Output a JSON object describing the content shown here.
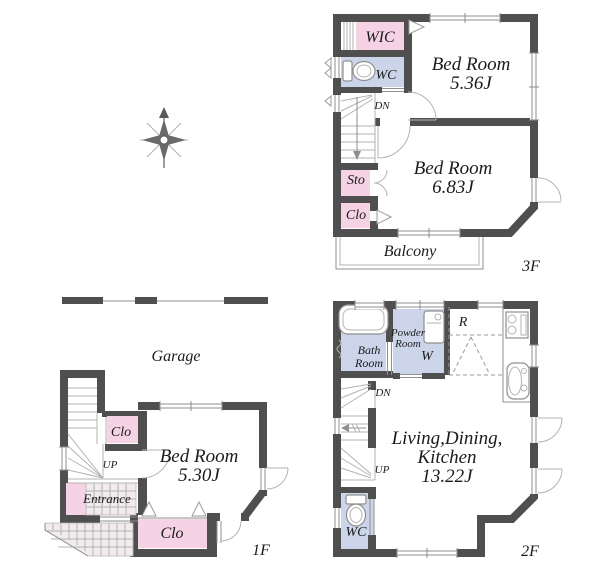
{
  "colors": {
    "wall": "#4f4f4f",
    "room_pink": "#f5d3e4",
    "room_blue": "#ccd4e9",
    "thin_line": "#8f8f8f",
    "tile": "#f2ebee"
  },
  "floor3": {
    "floor_label": "3F",
    "wic": "WIC",
    "wc": "WC",
    "dn": "DN",
    "bedroom_a": {
      "name": "Bed Room",
      "area": "5.36J"
    },
    "bedroom_b": {
      "name": "Bed Room",
      "area": "6.83J"
    },
    "sto": "Sto",
    "clo": "Clo",
    "balcony": "Balcony"
  },
  "floor2": {
    "floor_label": "2F",
    "bath": {
      "line1": "Bath",
      "line2": "Room"
    },
    "powder": {
      "line1": "Powder",
      "line2": "Room"
    },
    "washer": "W",
    "fridge": "R",
    "dn": "DN",
    "up": "UP",
    "ldk": {
      "line1": "Living,Dining,",
      "line2": "Kitchen",
      "area": "13.22J"
    },
    "wc": "WC"
  },
  "floor1": {
    "floor_label": "1F",
    "garage": "Garage",
    "clo_upper": "Clo",
    "up": "UP",
    "bedroom": {
      "name": "Bed Room",
      "area": "5.30J"
    },
    "entrance": "Entrance",
    "clo_lower": "Clo"
  }
}
